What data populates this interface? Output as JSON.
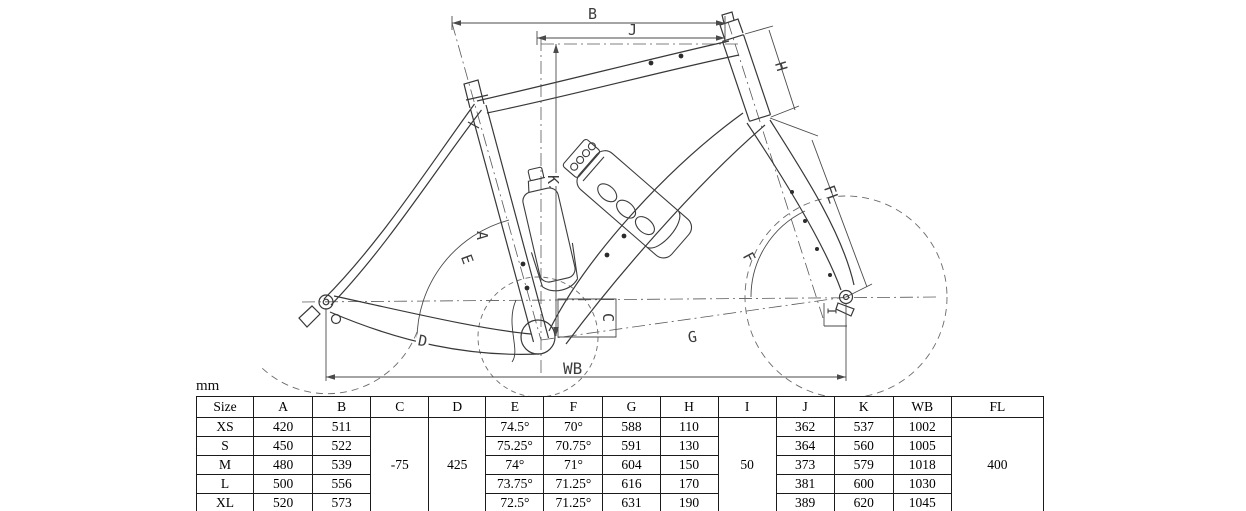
{
  "unit_label": "mm",
  "drawing": {
    "dim_labels": {
      "B": "B",
      "J": "J",
      "K": "K",
      "H": "H",
      "FL": "FL",
      "E": "E",
      "F": "F",
      "A": "A",
      "C": "C",
      "D": "D",
      "G": "G",
      "WB": "WB",
      "I": "I"
    }
  },
  "table": {
    "header": {
      "size": "Size",
      "A": "A",
      "B": "B",
      "C": "C",
      "D": "D",
      "E": "E",
      "F": "F",
      "G": "G",
      "H": "H",
      "I": "I",
      "J": "J",
      "K": "K",
      "WB": "WB",
      "FL": "FL"
    },
    "merged": {
      "C": "-75",
      "D": "425",
      "I": "50",
      "FL": "400"
    },
    "rows": [
      {
        "size": "XS",
        "A": "420",
        "B": "511",
        "E": "74.5°",
        "F": "70°",
        "G": "588",
        "H": "110",
        "J": "362",
        "K": "537",
        "WB": "1002"
      },
      {
        "size": "S",
        "A": "450",
        "B": "522",
        "E": "75.25°",
        "F": "70.75°",
        "G": "591",
        "H": "130",
        "J": "364",
        "K": "560",
        "WB": "1005"
      },
      {
        "size": "M",
        "A": "480",
        "B": "539",
        "E": "74°",
        "F": "71°",
        "G": "604",
        "H": "150",
        "J": "373",
        "K": "579",
        "WB": "1018"
      },
      {
        "size": "L",
        "A": "500",
        "B": "556",
        "E": "73.75°",
        "F": "71.25°",
        "G": "616",
        "H": "170",
        "J": "381",
        "K": "600",
        "WB": "1030"
      },
      {
        "size": "XL",
        "A": "520",
        "B": "573",
        "E": "72.5°",
        "F": "71.25°",
        "G": "631",
        "H": "190",
        "J": "389",
        "K": "620",
        "WB": "1045"
      }
    ]
  }
}
